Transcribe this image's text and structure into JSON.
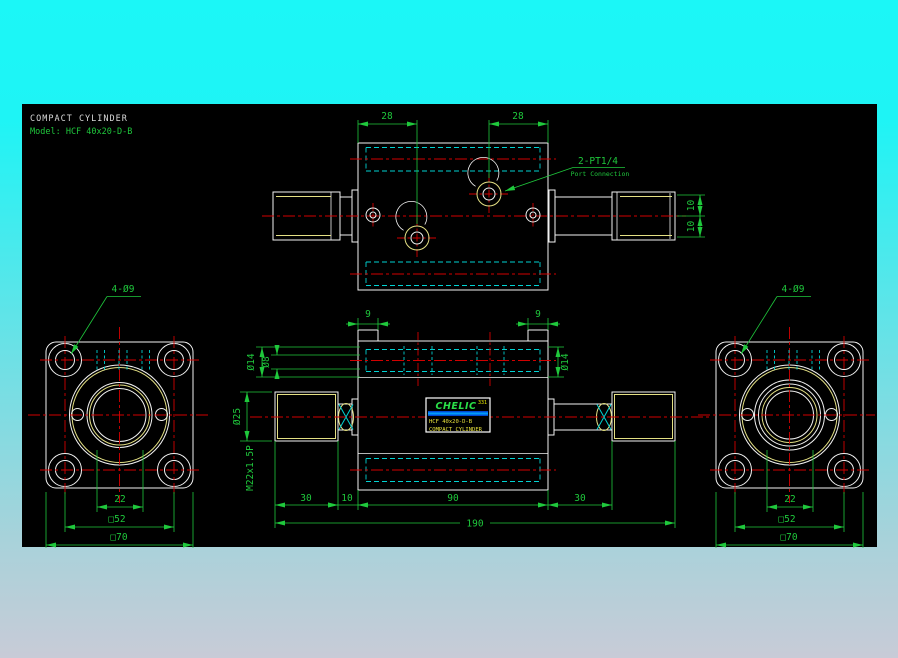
{
  "title": {
    "product": "COMPACT CYLINDER",
    "model": "Model: HCF 40x20-D-B"
  },
  "nameplate": {
    "brand": "CHELIC",
    "series": "331",
    "model": "HCF 40x20-D-B",
    "product": "COMPACT CYLINDER"
  },
  "top_view": {
    "dim_port_left": "28",
    "dim_port_right": "28",
    "port_callout_line1": "2-PT1/4",
    "port_callout_line2": "Port Connection",
    "dim_flat_upper": "10",
    "dim_flat_lower": "10"
  },
  "front_view": {
    "dim_boss_left": "9",
    "dim_boss_right": "9",
    "dim_bore_left_outer": "Ø14",
    "dim_bore_left_inner": "Ø8",
    "dim_bore_right": "Ø14",
    "dim_rod": "Ø25",
    "thread_label": "M22x1.5P",
    "dim_seg_rod_left": "30",
    "dim_seg_neck_left": "10",
    "dim_seg_body": "90",
    "dim_seg_neck_right": "30",
    "dim_total": "190"
  },
  "left_flange": {
    "callout": "4-Ø9",
    "dim_rod_sq": "22",
    "dim_bolt_sq": "□52",
    "dim_flange_sq": "□70"
  },
  "right_flange": {
    "callout": "4-Ø9",
    "dim_rod_sq": "22",
    "dim_bolt_sq": "□52",
    "dim_flange_sq": "□70"
  },
  "colors": {
    "background_top": "#1bf7f7",
    "background_bottom": "#c8cbd7",
    "canvas": "#000000",
    "object_line": "#f2f2f2",
    "dimension_green": "#1fc83c",
    "centerline_red": "#d20000",
    "hidden_cyan": "#00d2d2",
    "thread_yellow": "#e4e084",
    "brand_green": "#2adf48",
    "label_yellow": "#e8e23c",
    "stripe_blue": "#0064ff"
  }
}
